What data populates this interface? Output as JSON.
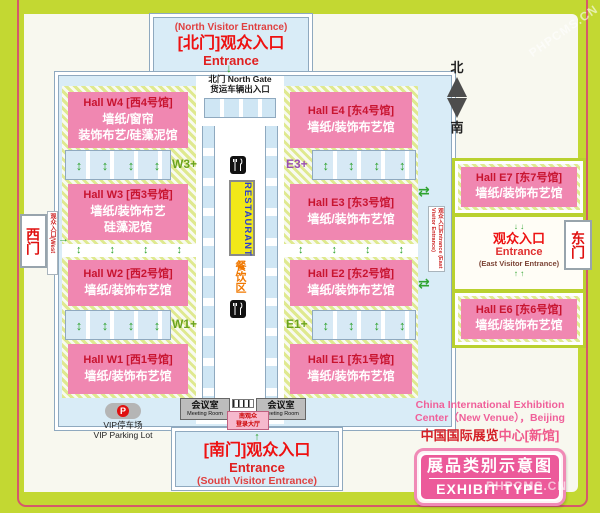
{
  "colors": {
    "frame_lime": "#c3d832",
    "frame_pinstripe": "#d5596b",
    "panel_cream": "#f8f8ef",
    "map_blue": "#d9ecf7",
    "hall_pink": "#f087b1",
    "hall_title_red": "#c81430",
    "entrance_red": "#ee1111",
    "badge_pink": "#ec5a9a",
    "restaurant_yellow": "#f2e818",
    "restaurant_blue": "#2b3fd0",
    "food_orange": "#f07800",
    "arrow_green": "#2fa32f"
  },
  "icons": {
    "up_down_arrow": "↕",
    "up_arrow": "↑",
    "down_arrow": "↓",
    "right_arrow": "→",
    "swap_arrow": "⇄"
  },
  "north": {
    "sub": "(North Visitor Entrance)",
    "title": "[北门]观众入口",
    "entrance": "Entrance",
    "gate1": "北门 North Gate",
    "gate2": "货运车辆出入口"
  },
  "compass": {
    "north": "北",
    "south": "南"
  },
  "west_gate": {
    "label": "西门",
    "note": "观众入口(West Visitor Entrance)"
  },
  "east_gate": {
    "label": "东门"
  },
  "east_side_label": "观众入口Entrance (East Visitor Entrance)",
  "halls_west": [
    {
      "title": "Hall W4 [西4号馆]",
      "sub1": "墙纸/窗帘",
      "sub2": "装饰布艺/硅藻泥馆"
    },
    {
      "title": "Hall W3 [西3号馆]",
      "sub1": "墙纸/装饰布艺",
      "sub2": "硅藻泥馆"
    },
    {
      "title": "Hall W2 [西2号馆]",
      "sub1": "墙纸/装饰布艺馆"
    },
    {
      "title": "Hall W1 [西1号馆]",
      "sub1": "墙纸/装饰布艺馆"
    }
  ],
  "halls_east": [
    {
      "title": "Hall E4 [东4号馆]",
      "sub1": "墙纸/装饰布艺馆"
    },
    {
      "title": "Hall E3 [东3号馆]",
      "sub1": "墙纸/装饰布艺馆"
    },
    {
      "title": "Hall E2 [东2号馆]",
      "sub1": "墙纸/装饰布艺馆"
    },
    {
      "title": "Hall E1 [东1号馆]",
      "sub1": "墙纸/装饰布艺馆"
    }
  ],
  "plus_labels": {
    "w3": "W3+",
    "w1": "W1+",
    "e3": "E3+",
    "e1": "E1+"
  },
  "center": {
    "restaurant": "RESTAURANT",
    "food_zone": "餐饮区"
  },
  "east_wing": {
    "e7": {
      "title": "Hall E7 [东7号馆]",
      "sub1": "墙纸/装饰布艺馆"
    },
    "entrance": {
      "cn": "观众入口",
      "en": "Entrance",
      "sub": "(East Visitor Entrance)"
    },
    "e6": {
      "title": "Hall E6 [东6号馆]",
      "sub1": "墙纸/装饰布艺馆"
    }
  },
  "south": {
    "meeting_cn": "会议室",
    "meeting_en": "Meeting Room",
    "reg1": "南观众",
    "reg2": "登录大厅",
    "title": "[南门]观众入口",
    "entrance": "Entrance",
    "sub": "(South Visitor Entrance)"
  },
  "vip": {
    "p": "P",
    "cn": "VIP停车场",
    "en": "VIP Parking Lot"
  },
  "footer": {
    "en1": "China International Exhibition",
    "en2": "Center（New Venue），Beijing",
    "cn_red": "中国国际展览",
    "cn_pink": "中心[新馆]"
  },
  "badge": {
    "cn": "展品类别示意图",
    "en": "EXHIBIT TYPE"
  },
  "watermark": {
    "text": "PHPCMS.CN"
  }
}
